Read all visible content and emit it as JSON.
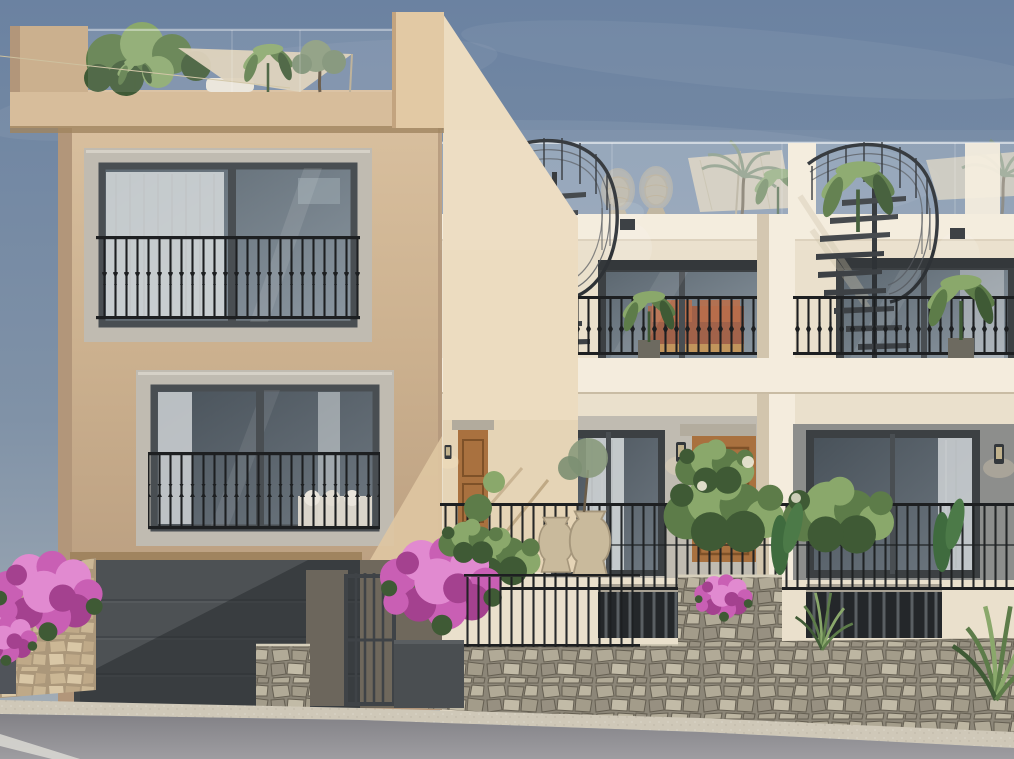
{
  "meta": {
    "width": 1014,
    "height": 759
  },
  "scene": {
    "title": "Architectural rendering of Mediterranean townhouses",
    "description": "Photorealistic street-elevation render: a tan two-storey house with juliet-balcony windows, rooftop garden and dark garage door on the left; cream new-build townhouses on the right with glass-fronted roof terraces, black spiral staircases, iron railings, timber front doors, bougainvillea planting and a rubble stone retaining wall above an asphalt road.",
    "objects": [
      "sky",
      "left-house",
      "rooftop-garden",
      "shade-sail",
      "upper-window",
      "lower-window",
      "juliet-railing",
      "garage-door",
      "entrance-gate",
      "townhouse-a",
      "townhouse-b",
      "spiral-staircase",
      "roof-terrace",
      "parasol",
      "egg-chair",
      "sliding-door",
      "timber-door",
      "wall-lantern",
      "terrace-railing",
      "stone-wall",
      "bougainvillea",
      "planting",
      "road"
    ]
  },
  "palette": {
    "sky_top": "#6b82a1",
    "sky_mid": "#8092a7",
    "sky_low": "#a8b1b8",
    "cloud": "#ffffff",
    "tan_light": "#d8bf9e",
    "tan": "#cbb08e",
    "tan_dark": "#b2967a",
    "tan_deep": "#a0845f",
    "cornice": "#d7bd9b",
    "wedge": "#ecdcc0",
    "wedge_shade": "#d9c5a4",
    "cream": "#eae0cc",
    "cream_lit": "#f4ecdd",
    "cream_shade": "#d2c5ad",
    "gray_return": "#8d8e8c",
    "stone_frame": "#c0bbb1",
    "stone_frame_lt": "#d6d1c7",
    "sash": "#494e52",
    "sash_dark": "#3c4043",
    "glass_hi": "#8b97a1",
    "glass_lo": "#5d6871",
    "glass_d_hi": "#6e7881",
    "glass_d_lo": "#49525a",
    "curtain": "#d6dadc",
    "rail": "#1d1f21",
    "metal": "#55595e",
    "metal_dark": "#2e3236",
    "tread": "#3d4145",
    "garage": "#4d5154",
    "garage_hi": "#5a5e61",
    "shadow_dk": "#26292c",
    "gate": "#3f4347",
    "planter": "#4a4e51",
    "shade_wall": "#6c665c",
    "stone_base": "#8c8678",
    "stone_a": "#b1aa97",
    "stone_b": "#a39c8a",
    "stone_c": "#bdb6a2",
    "stone_d": "#979081",
    "stone_e": "#c2bba7",
    "stone_joint": "#655f52",
    "bstone_base": "#ab977a",
    "bstone_a": "#cbb795",
    "bstone_b": "#d9c7a6",
    "bstone_c": "#bfa988",
    "curb": "#cfc8b8",
    "road_hi": "#9e9da1",
    "road_lo": "#828186",
    "white_line": "#dad9d4",
    "pink": "#c95fb4",
    "pink_light": "#e18ad0",
    "pink_dark": "#a4418f",
    "green": "#5d7c49",
    "green_light": "#8aa86b",
    "green_dark": "#3f5a35",
    "green_gray": "#7c8f72",
    "wood": "#a9713f",
    "wood_dark": "#7e5128",
    "wicker": "#cbb99a",
    "wicker_dk": "#b8a584",
    "parasol": "#dbcfb6",
    "daybed": "#e9e4d8",
    "rust": "#a85c3d",
    "rust_hi": "#b96f4b",
    "int_wood": "#c49a5e",
    "lamp_body": "#33373b",
    "lamp_glow": "#ffe9bf"
  }
}
